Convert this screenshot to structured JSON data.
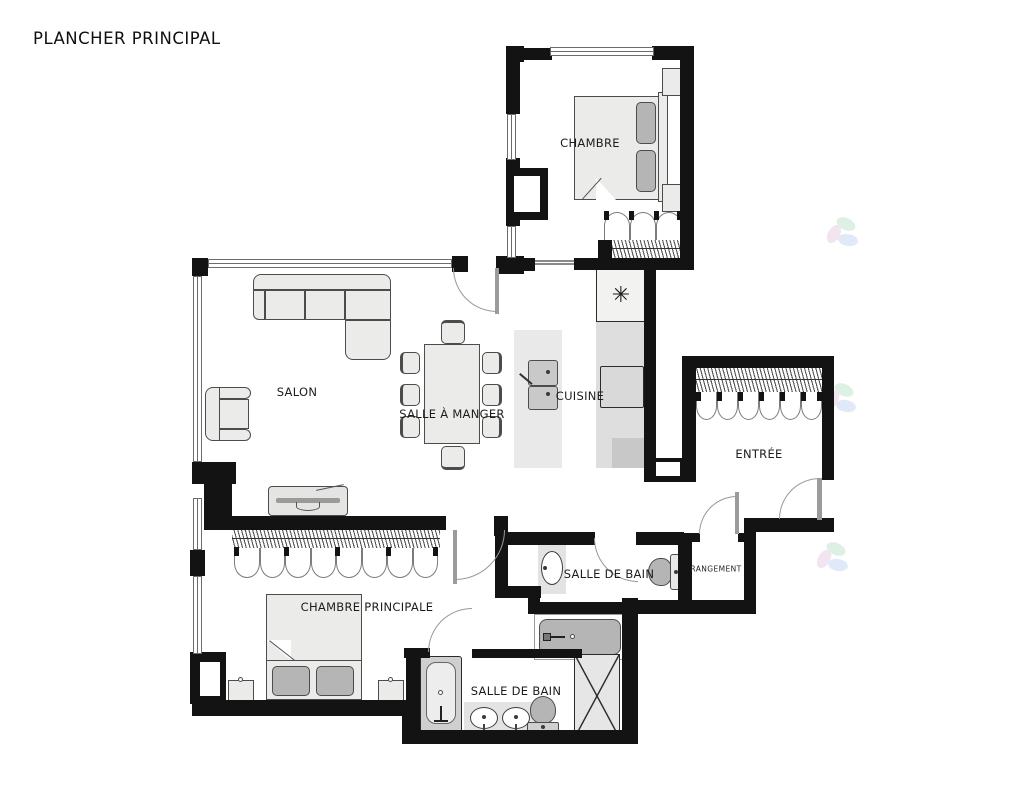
{
  "title": "PLANCHER PRINCIPAL",
  "rooms": {
    "chambre": "CHAMBRE",
    "salon": "SALON",
    "salle_a_manger": "SALLE À MANGER",
    "cuisine": "CUISINE",
    "entree": "ENTRÉE",
    "salle_de_bain": "SALLE DE BAIN",
    "rangement": "RANGEMENT",
    "chambre_principale": "CHAMBRE PRINCIPALE",
    "salle_de_bain_2": "SALLE DE BAIN"
  },
  "icons": {
    "fridge_snowflake": "✳"
  },
  "colors": {
    "wall": "#131313",
    "furniture_fill": "#ebebe9",
    "furniture_stroke": "#4c4c4c",
    "dark_fill": "#b5b5b5",
    "counter": "#dedede",
    "counter_dark": "#c8c8c8",
    "island": "#e9e9e9",
    "door_arc": "#999999",
    "watermark_green": "#bfe3c8",
    "watermark_pink": "#e8cde2",
    "watermark_blue": "#c5d5f3"
  }
}
